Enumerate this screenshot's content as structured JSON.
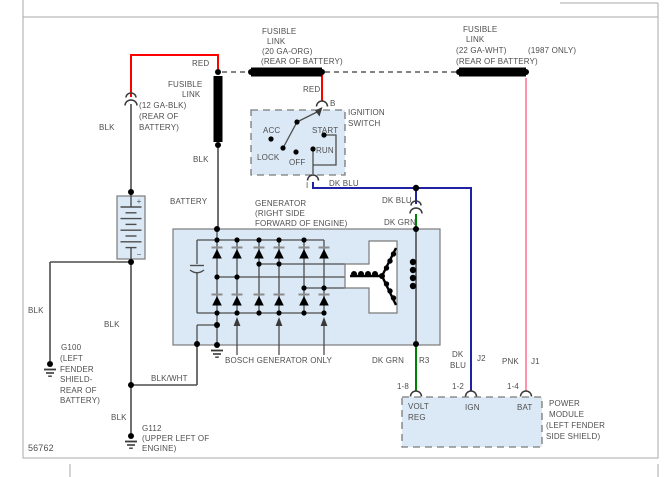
{
  "diagram_number": "56762",
  "colors": {
    "red_wire": "#ff0000",
    "pink_wire": "#ff93ac",
    "dark_blue_wire": "#2121a3",
    "dark_green_wire": "#008000",
    "black_wire": "#4d4d4d",
    "component_fill": "#dbe9f6"
  },
  "fusible_link_12ga": {
    "lines": [
      "FUSIBLE",
      "LINK",
      "(12 GA-BLK)",
      "(REAR OF",
      "BATTERY)"
    ]
  },
  "fusible_link_20ga": {
    "lines": [
      "FUSIBLE",
      "LINK",
      "(20 GA-ORG)",
      "(REAR OF BATTERY)"
    ]
  },
  "fusible_link_22ga": {
    "lines": [
      "FUSIBLE",
      "LINK",
      "(22 GA-WHT)",
      "(REAR OF BATTERY)"
    ],
    "note": "(1987 ONLY)"
  },
  "wire_labels": {
    "red_top": "RED",
    "red_ignition": "RED",
    "blk_battery_top": "BLK",
    "blk_fusible": "BLK",
    "blk_left_ground": "BLK",
    "blk_mid": "BLK",
    "blk_lower": "BLK",
    "blk_wht": "BLK/WHT",
    "dk_blu_switch": "DK BLU",
    "dk_blu_drop": "DK BLU",
    "dk_grn_top": "DK GRN",
    "dk_grn_bottom": "DK GRN",
    "dk_blu_col_1": "DK",
    "dk_blu_col_2": "BLU",
    "pnk": "PNK"
  },
  "battery": {
    "label": "BATTERY",
    "plus": "+",
    "minus": "−"
  },
  "ignition_switch": {
    "label_lines": [
      "IGNITION",
      "SWITCH"
    ],
    "positions": {
      "acc": "ACC",
      "lock": "LOCK",
      "off": "OFF",
      "run": "RUN",
      "start": "START"
    },
    "terminals": {
      "b": "B",
      "i": "I"
    }
  },
  "generator": {
    "label_lines": [
      "GENERATOR",
      "(RIGHT SIDE",
      "FORWARD OF ENGINE)"
    ],
    "bosch_note": "BOSCH GENERATOR ONLY"
  },
  "grounds": {
    "g100_lines": [
      "G100",
      "(LEFT",
      "FENDER",
      "SHIELD-",
      "REAR OF",
      "BATTERY)"
    ],
    "g112_lines": [
      "G112",
      "(UPPER LEFT OF",
      "ENGINE)"
    ]
  },
  "connector_refs": {
    "r3": "R3",
    "j2": "J2",
    "j1": "J1"
  },
  "power_module": {
    "label_lines": [
      "POWER",
      "MODULE",
      "(LEFT FENDER",
      "SIDE SHIELD)"
    ],
    "terminals": {
      "volt_reg_lines": [
        "VOLT",
        "REG"
      ],
      "ign": "IGN",
      "bat": "BAT"
    },
    "pins": {
      "volt_reg": "1-8",
      "ign": "1-2",
      "bat": "1-4"
    }
  }
}
